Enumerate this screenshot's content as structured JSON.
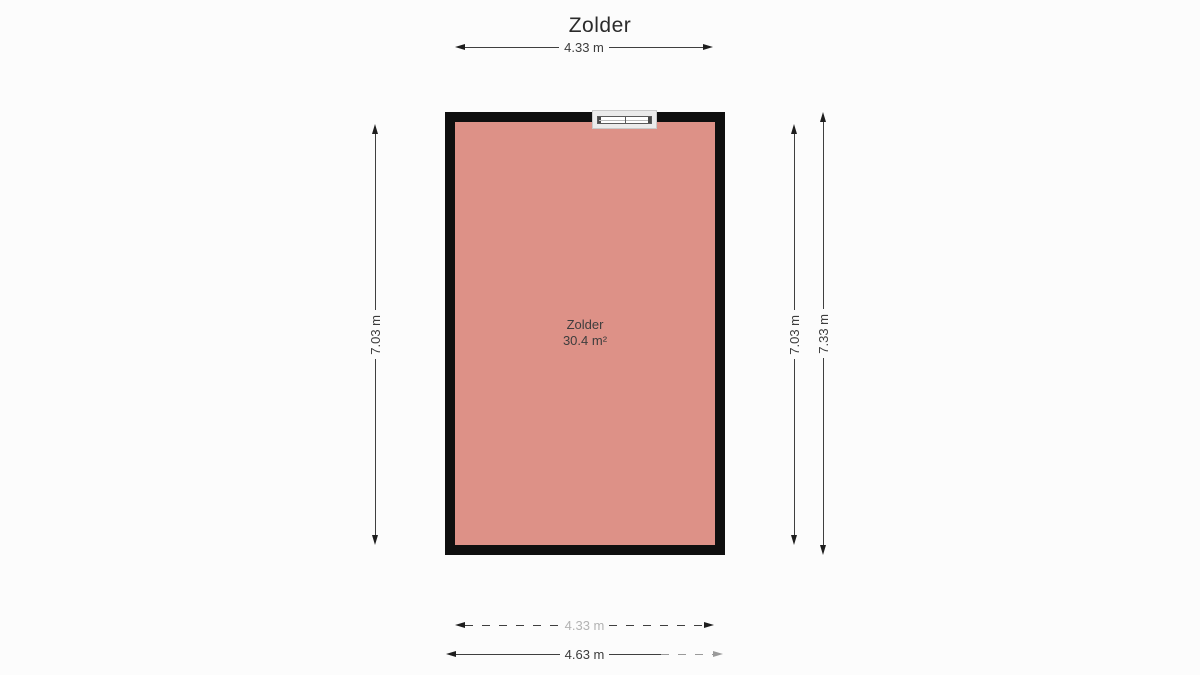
{
  "title": "Zolder",
  "room": {
    "label": "Zolder",
    "area": "30.4 m²"
  },
  "dimensions": {
    "top_width": "4.33 m",
    "left_height": "7.03 m",
    "right_inner_height": "7.03 m",
    "right_outer_height": "7.33 m",
    "bottom_inner_width": "4.33 m",
    "bottom_outer_width": "4.63 m"
  },
  "colors": {
    "floor": "#dd9187",
    "wall": "#0f0f0f",
    "background": "#fcfcfc",
    "dimension_line": "#3f3f3f",
    "faded_label": "#b3b3b3"
  },
  "icons": {
    "window": "double-pane-window-glyph",
    "arrows": "double-headed-dimension-arrow"
  }
}
